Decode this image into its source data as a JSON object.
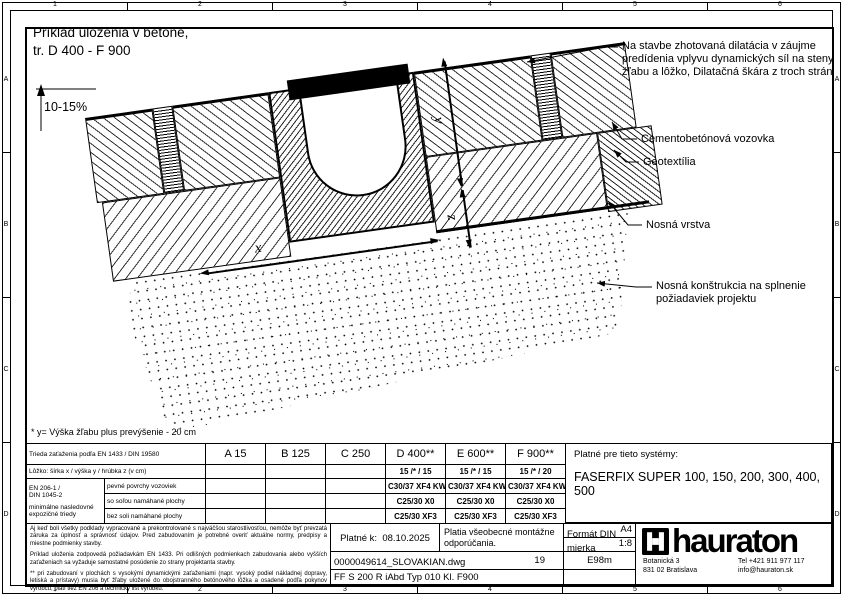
{
  "frame": {
    "column_labels": [
      "1",
      "2",
      "3",
      "4",
      "5",
      "6"
    ],
    "row_labels": [
      "A",
      "B",
      "C",
      "D"
    ]
  },
  "drawing": {
    "title_line1": "Príklad uloženia v betóne,",
    "title_line2": "tr. D 400 - F 900",
    "slope_label": "10-15%",
    "dim_x": "x",
    "dim_y": "y",
    "dim_z": "z",
    "callouts": [
      "Na stavbe zhotovaná dilatácia v záujme predídenia vplyvu dynamických síl na steny žľabu a lôžko, Dilatačná škára z troch strán",
      "Cementobetónová vozovka",
      "Geotextília",
      "Nosná vrstva",
      "Nosná konštrukcia na splnenie požiadaviek projektu"
    ],
    "footnote": "* y= Výška žľabu plus prevýšenie - 20 cm"
  },
  "load_table": {
    "class_row_label": "Trieda zaťaženia podľa EN 1433 / DIN 19580",
    "classes": [
      "A 15",
      "B 125",
      "C 250",
      "D 400**",
      "E 600**",
      "F 900**"
    ],
    "bedding_row_label": "Lôžko: šírka x / výška y / hrúbka z (v cm)",
    "bedding_values": [
      "",
      "",
      "",
      "15 /* / 15",
      "15 /* / 15",
      "15 /* / 20"
    ],
    "concrete_label_line1": "EN 206-1 /",
    "concrete_label_line2": "DIN 1045-2",
    "concrete_label_line3": "minimálne nasledovné expozičné triedy",
    "concrete_rows": [
      {
        "label": "pevné povrchy vozoviek",
        "values": [
          "",
          "",
          "",
          "C30/37 XF4 KW",
          "C30/37 XF4 KW",
          "C30/37 XF4 KW"
        ]
      },
      {
        "label": "so soľou namáhané plochy",
        "values": [
          "",
          "",
          "",
          "C25/30 X0",
          "C25/30 X0",
          "C25/30 X0"
        ]
      },
      {
        "label": "bez soli namáhané plochy",
        "values": [
          "",
          "",
          "",
          "C25/30 XF3",
          "C25/30 XF3",
          "C25/30 XF3"
        ]
      }
    ],
    "systems_label": "Platné pre tieto systémy:",
    "systems_value": "FASERFIX SUPER 100, 150, 200, 300, 400, 500"
  },
  "disclaimer": {
    "p1": "Aj keď boli všetky podklady vypracované a prekontrolované s najväčšou starostlivosťou, nemôže byť prevzatá záruka za úplnosť a správnosť údajov. Pred zabudovaním je potrebné overiť aktuálne normy, predpisy a miestne podmienky stavby.",
    "p2": "Príklad uloženia zodpovedá požiadavkám EN 1433. Pri odlišných podmienkach zabudovania alebo vyšších zaťaženiach sa vyžaduje samostatné posúdenie zo strany projektanta stavby.",
    "p3": "** pri zabudovaní v plochách s vysokými dynamickými zaťaženiami (napr. vysoký podiel nákladnej dopravy, letiská a prístavy) musia byť žľaby uložené do obojstranného betónového lôžka a osadené podľa pokynov výrobcu; platí tiež EN 206 a technický list výrobku."
  },
  "title_block": {
    "valid_label": "Platné k:",
    "valid_date": "08.10.2025",
    "note": "Platia všeobecné montážne odporúčania.",
    "format_label": "Formát DIN",
    "format_value": "A4",
    "scale_label": "mierka",
    "scale_value": "1:8",
    "file_name": "0000049614_SLOVAKIAN.dwg",
    "sheet_number": "19",
    "code": "E98m",
    "product_code": "FF S 200 R iAbd Typ 010 Kl. F900",
    "brand": "hauraton",
    "address_line1": "Botanická 3",
    "address_line2": "831 02 Bratislava",
    "phone": "Tel +421 911 977 117",
    "email": "info@hauraton.sk"
  }
}
